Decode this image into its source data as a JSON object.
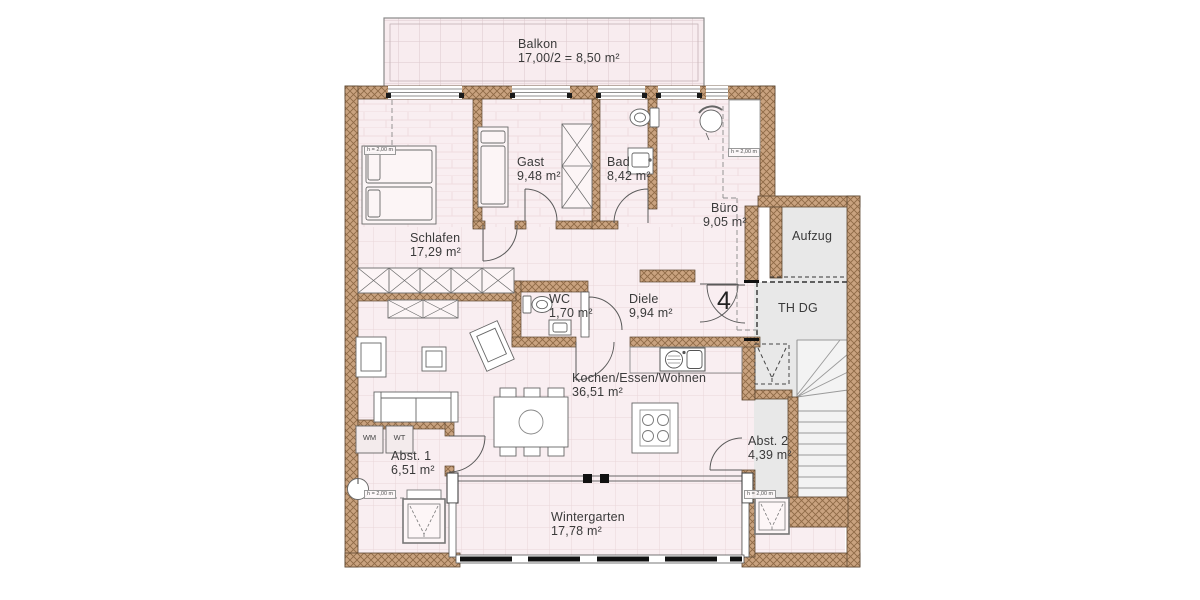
{
  "rooms": {
    "balkon": {
      "name": "Balkon",
      "area": "17,00/2 = 8,50 m²"
    },
    "gast": {
      "name": "Gast",
      "area": "9,48 m²"
    },
    "bad": {
      "name": "Bad",
      "area": "8,42 m²"
    },
    "buero": {
      "name": "Büro",
      "area": "9,05 m²"
    },
    "schlafen": {
      "name": "Schlafen",
      "area": "17,29 m²"
    },
    "wc": {
      "name": "WC",
      "area": "1,70 m²"
    },
    "diele": {
      "name": "Diele",
      "area": "9,94 m²"
    },
    "kochen": {
      "name": "Kochen/Essen/Wohnen",
      "area": "36,51 m²"
    },
    "abst1": {
      "name": "Abst. 1",
      "area": "6,51 m²"
    },
    "wintergarten": {
      "name": "Wintergarten",
      "area": "17,78 m²"
    },
    "abst2": {
      "name": "Abst. 2",
      "area": "4,39 m²"
    },
    "aufzug": {
      "name": "Aufzug"
    },
    "thdg": {
      "name": "TH DG"
    }
  },
  "unit": {
    "number": "4"
  },
  "appliances": {
    "wm": "WM",
    "wt": "WT"
  },
  "height_note": "h = 2,00 m",
  "colors": {
    "floor": "#f9eef1",
    "floor_grid": "#e9d6d9",
    "wall": "#c9a27f",
    "wall_hatch": "#8f6a47",
    "stairwell_gray": "#e8e8e8",
    "line": "#5c4630",
    "text": "#3a3a3a"
  }
}
